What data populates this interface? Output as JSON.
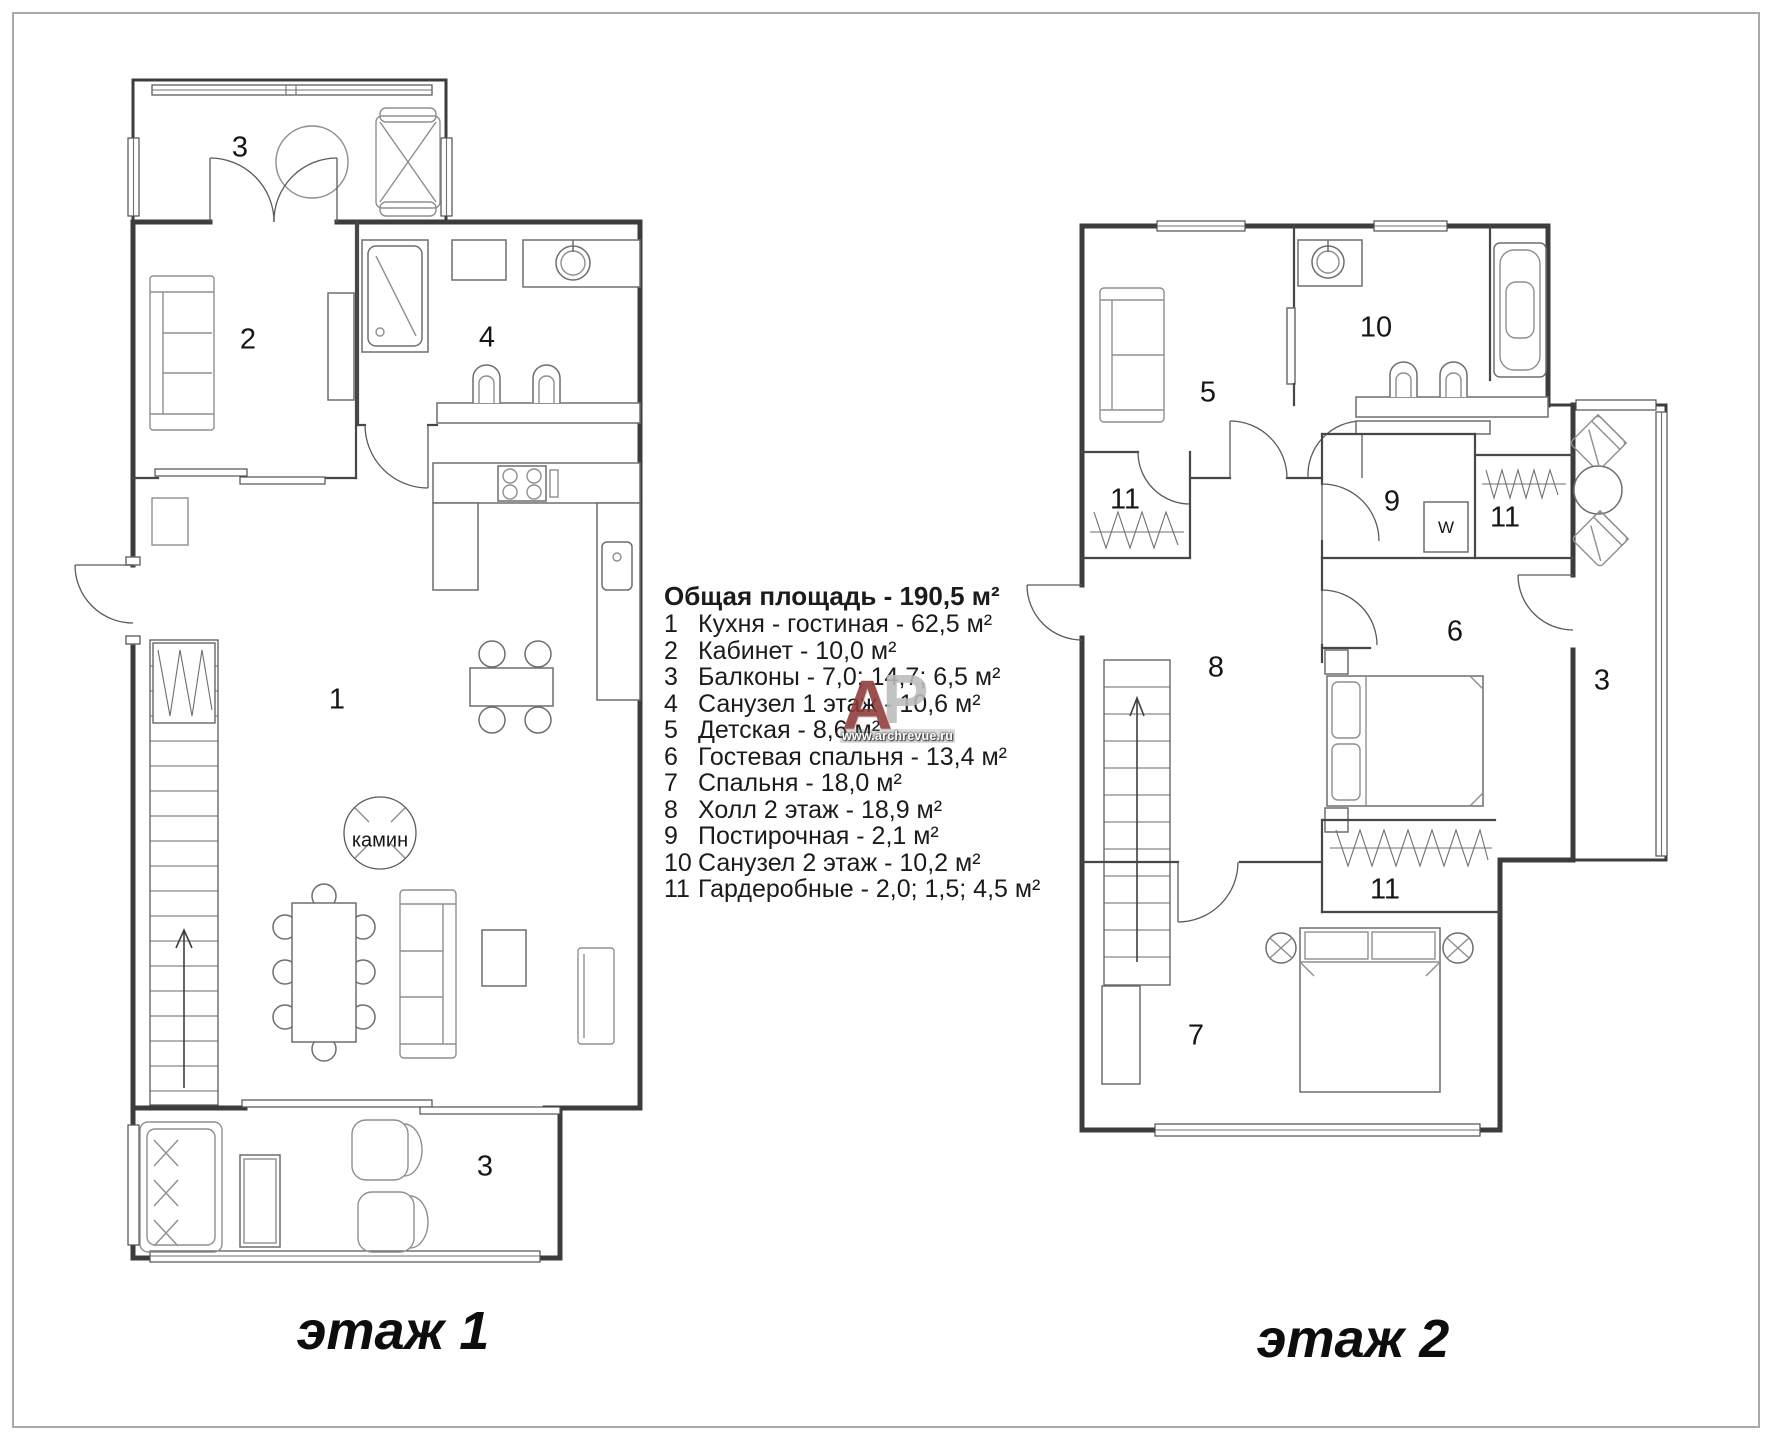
{
  "legend": {
    "title": "Общая площадь - 190,5 м²",
    "items": [
      {
        "num": "1",
        "text": "Кухня - гостиная - 62,5 м²"
      },
      {
        "num": "2",
        "text": "Кабинет - 10,0 м²"
      },
      {
        "num": "3",
        "text": "Балконы - 7,0; 14,7; 6,5 м²"
      },
      {
        "num": "4",
        "text": "Санузел 1 этаж - 10,6 м²"
      },
      {
        "num": "5",
        "text": "Детская - 8,6 м²"
      },
      {
        "num": "6",
        "text": "Гостевая спальня - 13,4 м²"
      },
      {
        "num": "7",
        "text": "Спальня - 18,0 м²"
      },
      {
        "num": "8",
        "text": "Холл 2 этаж - 18,9 м²"
      },
      {
        "num": "9",
        "text": "Постирочная - 2,1 м²"
      },
      {
        "num": "10",
        "text": "Санузел 2 этаж - 10,2 м²"
      },
      {
        "num": "11",
        "text": "Гардеробные - 2,0; 1,5; 4,5 м²"
      }
    ]
  },
  "floor1": {
    "caption": "этаж 1",
    "labels": {
      "balcony_top": "3",
      "office": "2",
      "bathroom": "4",
      "living": "1",
      "fireplace": "камин",
      "balcony_bottom": "3"
    }
  },
  "floor2": {
    "caption": "этаж 2",
    "labels": {
      "kids_room": "5",
      "bathroom": "10",
      "wardrobe_left": "11",
      "laundry": "9",
      "washer": "W",
      "wardrobe_right": "11",
      "hall": "8",
      "guest_bedroom": "6",
      "balcony": "3",
      "closet": "11",
      "bedroom": "7"
    }
  },
  "watermark": {
    "letter_a": "А",
    "letter_r": "Р",
    "url": "www.archrevue.ru",
    "color_a": "#8e3a38",
    "color_r": "#bdbdbd"
  }
}
